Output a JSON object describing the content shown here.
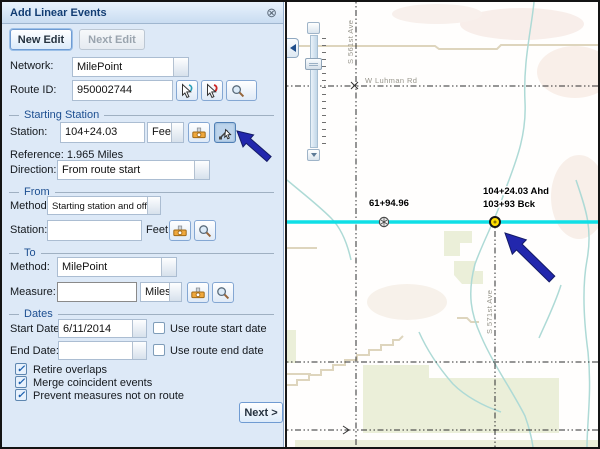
{
  "window": {
    "title": "Add Linear Events"
  },
  "icons": {
    "close": "⊗",
    "check": "✓"
  },
  "actions": {
    "new_edit": "New Edit",
    "next_edit": "Next Edit",
    "next": "Next >"
  },
  "form": {
    "network": {
      "label": "Network:",
      "value": "MilePoint"
    },
    "route_id": {
      "label": "Route ID:",
      "value": "950002744"
    },
    "starting_station": {
      "section": "Starting Station",
      "station_label": "Station:",
      "station_value": "104+24.03",
      "units": "Feet",
      "reference": "Reference: 1.965 Miles",
      "direction_label": "Direction:",
      "direction_value": "From route start"
    },
    "from": {
      "section": "From",
      "method_label": "Method:",
      "method_value": "Starting station and offset",
      "station_label": "Station:",
      "station_value": "",
      "units": "Feet"
    },
    "to": {
      "section": "To",
      "method_label": "Method:",
      "method_value": "MilePoint",
      "measure_label": "Measure:",
      "measure_value": "",
      "units": "Miles"
    },
    "dates": {
      "section": "Dates",
      "start_label": "Start Date:",
      "start_value": "6/11/2014",
      "start_option": "Use route start date",
      "end_label": "End Date:",
      "end_value": "",
      "end_option": "Use route end date"
    },
    "options": [
      {
        "label": "Retire overlaps",
        "checked": true
      },
      {
        "label": "Merge coincident events",
        "checked": true
      },
      {
        "label": "Prevent measures not on route",
        "checked": true
      }
    ]
  },
  "map": {
    "roads": {
      "horizontal": "W Luhman Rd",
      "vertical_left": "S 561st Ave",
      "vertical_right": "S 571st Ave"
    },
    "measurements": {
      "reference_point": "61+94.96",
      "selected_ahead": "104+24.03 Ahd",
      "selected_back": "103+93 Bck"
    }
  },
  "colors": {
    "route": "#0fdfe6",
    "marker": "#ffdf00",
    "annotation_arrow": "#2227ad",
    "panel_accent": "#1d4f91"
  }
}
